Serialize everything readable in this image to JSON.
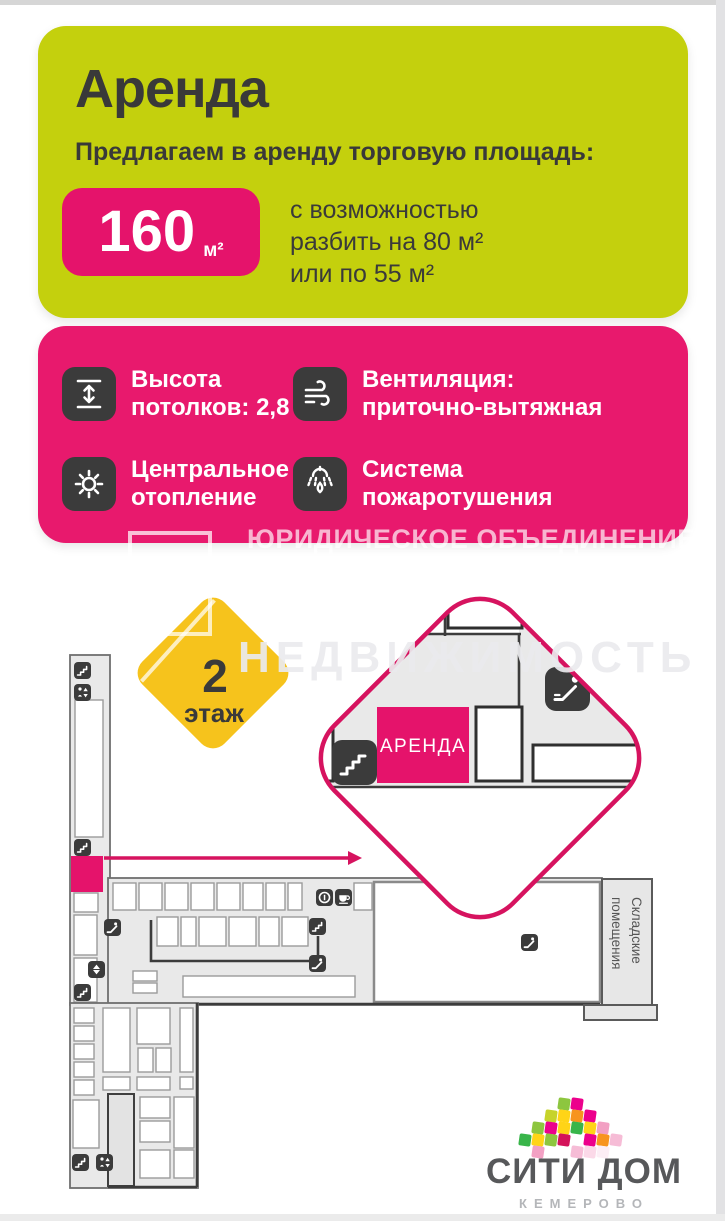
{
  "offer_card": {
    "bg": "#c4d00d",
    "title": "Аренда",
    "subtitle": "Предлагаем в аренду торговую площадь:",
    "area": {
      "value": "160",
      "unit": "м²",
      "box_color": "#e5136b"
    },
    "description_lines": [
      "с возможностью",
      "разбить на 80 м²",
      "или по 55 м²"
    ]
  },
  "features_card": {
    "bg": "#e8196d",
    "icon_bg": "#3b3b3b",
    "items": [
      {
        "icon": "ceiling-height-icon",
        "line1": "Высота",
        "line2": "потолков: 2,8 м"
      },
      {
        "icon": "ventilation-icon",
        "line1": "Вентиляция:",
        "line2": "приточно-вытяжная"
      },
      {
        "icon": "heating-icon",
        "line1": "Центральное",
        "line2": "отопление"
      },
      {
        "icon": "fire-suppression-icon",
        "line1": "Система",
        "line2": "пожаротушения"
      }
    ]
  },
  "watermarks": {
    "legal": "ЮРИДИЧЕСКОЕ ОБЪЕДИНЕНИЕ",
    "estate": "НЕДВИЖИМОСТЬ"
  },
  "floor_plan": {
    "badge": {
      "number": "2",
      "label": "этаж",
      "bg": "#f6c31c"
    },
    "callout_label": "АРЕНДА",
    "accent": "#d6135f",
    "highlight": "#e5136b",
    "storage_label_lines": [
      "Складские",
      "помещения"
    ],
    "icon_legend": [
      "stairs-icon",
      "escalator-icon",
      "elevator-icon",
      "lift-icon",
      "info-icon",
      "cafe-icon"
    ]
  },
  "logo": {
    "title": "СИТИ ДОМ",
    "subtitle": "КЕМЕРОВО",
    "tile_size": 12,
    "tiles": [
      {
        "x": 90,
        "y": 12,
        "c": "#8dc63f"
      },
      {
        "x": 103,
        "y": 12,
        "c": "#ec008c"
      },
      {
        "x": 77,
        "y": 24,
        "c": "#c6d32b"
      },
      {
        "x": 90,
        "y": 24,
        "c": "#ffd417"
      },
      {
        "x": 103,
        "y": 24,
        "c": "#f7941e"
      },
      {
        "x": 116,
        "y": 24,
        "c": "#ec008c"
      },
      {
        "x": 64,
        "y": 36,
        "c": "#8dc63f"
      },
      {
        "x": 77,
        "y": 36,
        "c": "#ec008c"
      },
      {
        "x": 90,
        "y": 36,
        "c": "#ffd417"
      },
      {
        "x": 103,
        "y": 36,
        "c": "#39b54a"
      },
      {
        "x": 116,
        "y": 36,
        "c": "#ffd417"
      },
      {
        "x": 129,
        "y": 36,
        "c": "#f2a0c3"
      },
      {
        "x": 51,
        "y": 48,
        "c": "#39b54a"
      },
      {
        "x": 64,
        "y": 48,
        "c": "#ffd417"
      },
      {
        "x": 77,
        "y": 48,
        "c": "#8dc63f"
      },
      {
        "x": 90,
        "y": 48,
        "c": "#d4145a"
      },
      {
        "x": 116,
        "y": 48,
        "c": "#ec008c"
      },
      {
        "x": 129,
        "y": 48,
        "c": "#f7941e"
      },
      {
        "x": 142,
        "y": 48,
        "c": "#f6bcd6"
      },
      {
        "x": 64,
        "y": 60,
        "c": "#f2a0c3"
      },
      {
        "x": 103,
        "y": 60,
        "c": "#f6bcd6"
      },
      {
        "x": 116,
        "y": 60,
        "c": "#fbd9e8"
      },
      {
        "x": 129,
        "y": 60,
        "c": "#fceef5"
      }
    ]
  }
}
